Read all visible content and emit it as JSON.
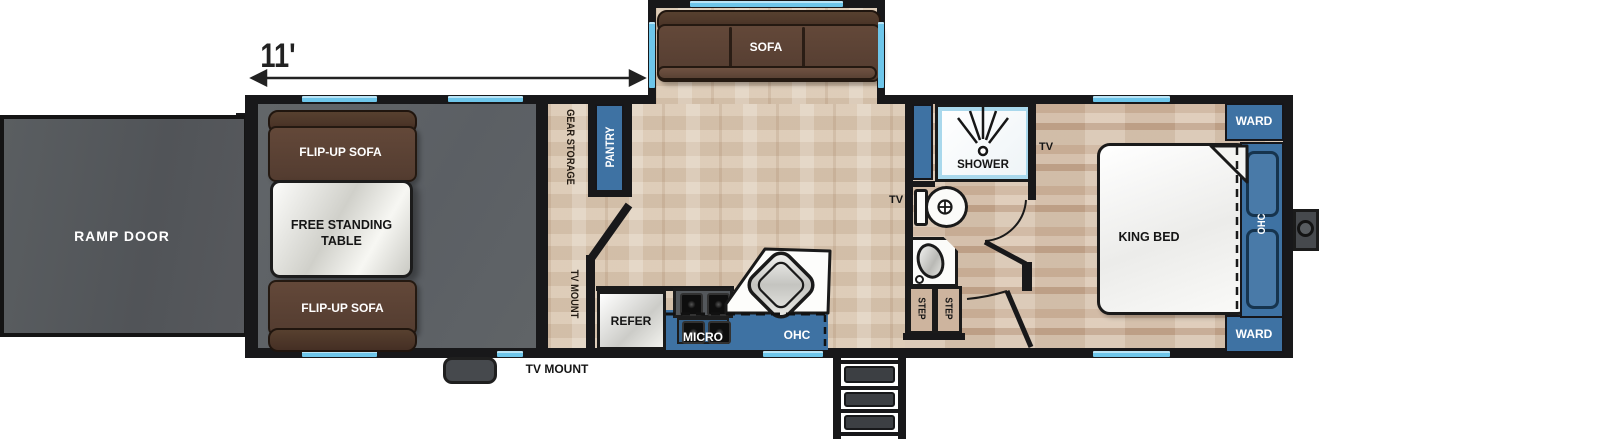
{
  "plan": {
    "dimension_label": "11'",
    "exterior": {
      "ramp_door": "RAMP DOOR",
      "tv_mount": "TV MOUNT"
    },
    "garage": {
      "flip_up_sofa_top": "FLIP-UP SOFA",
      "free_standing_table_line1": "FREE STANDING",
      "free_standing_table_line2": "TABLE",
      "flip_up_sofa_bottom": "FLIP-UP SOFA",
      "gear_storage": "GEAR STORAGE",
      "tv_mount_wall": "TV MOUNT"
    },
    "living": {
      "sofa": "SOFA",
      "pantry": "PANTRY"
    },
    "kitchen": {
      "refer": "REFER",
      "micro": "MICRO",
      "ohc": "OHC"
    },
    "bath": {
      "shower": "SHOWER",
      "tv_kitchen_side": "TV",
      "step_left": "STEP",
      "step_right": "STEP"
    },
    "bedroom": {
      "tv": "TV",
      "king_bed": "KING BED",
      "ward_top": "WARD",
      "ward_bottom": "WARD",
      "ohc": "OHC"
    },
    "colors": {
      "accent_blue": "#3e72a3",
      "window_blue": "#7ccdec",
      "wall_black": "#18181a",
      "garage_gray": "#5f6369",
      "ramp_gray": "#54585b",
      "sofa_brown": "#5b4236",
      "wood_tan": "#d8c5b0"
    }
  }
}
